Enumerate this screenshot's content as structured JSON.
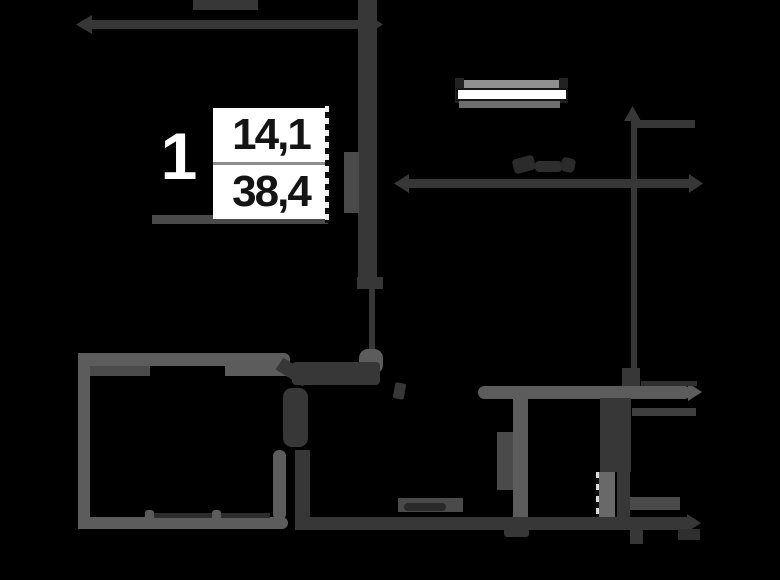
{
  "label": {
    "rooms": "1",
    "living_area": "14,1",
    "total_area": "38,4"
  },
  "palette": {
    "bg": "#000000",
    "dark": "#373737",
    "wall": "#5c5c5c",
    "medium": "#4a4a4a",
    "light": "#909090",
    "white": "#ffffff"
  },
  "plan": {
    "shapes": [
      {
        "name": "roof-stub",
        "type": "rect",
        "x": 193,
        "y": 0,
        "w": 65,
        "h": 10,
        "color": "dark"
      },
      {
        "name": "top-dim-line",
        "type": "rect",
        "x": 90,
        "y": 20,
        "w": 282,
        "h": 9,
        "color": "dark"
      },
      {
        "name": "top-dim-arrow-left",
        "type": "tri-left",
        "x": 76,
        "y": 15,
        "w": 16,
        "h": 19,
        "color": "dark"
      },
      {
        "name": "top-dim-arrow-right",
        "type": "tri-right",
        "x": 368,
        "y": 15,
        "w": 15,
        "h": 19,
        "color": "dark"
      },
      {
        "name": "upper-wall-vertical",
        "type": "rect",
        "x": 358,
        "y": 0,
        "w": 19,
        "h": 281,
        "color": "dark"
      },
      {
        "name": "upper-wall-side-block",
        "type": "rect",
        "x": 344,
        "y": 152,
        "w": 15,
        "h": 61,
        "color": "medium"
      },
      {
        "name": "upper-wall-break-block",
        "type": "rect",
        "x": 357,
        "y": 277,
        "w": 26,
        "h": 12,
        "color": "dark"
      },
      {
        "name": "upper-wall-thin",
        "type": "rect",
        "x": 369,
        "y": 283,
        "w": 6,
        "h": 68,
        "color": "dark"
      },
      {
        "name": "wall-junction-cap",
        "type": "rect",
        "x": 359,
        "y": 349,
        "w": 24,
        "h": 25,
        "r": 9,
        "color": "wall"
      },
      {
        "name": "label-underline-wall",
        "type": "rect",
        "x": 152,
        "y": 215,
        "w": 176,
        "h": 9,
        "color": "medium"
      },
      {
        "name": "label-dashed-line",
        "type": "dashes-v",
        "x": 325,
        "y": 106,
        "w": 4,
        "h": 117,
        "c1": "#f0f0f0",
        "c2": "#0d0d0d"
      },
      {
        "name": "window-top-bar",
        "type": "rect",
        "x": 458,
        "y": 80,
        "w": 104,
        "h": 8,
        "color": "light"
      },
      {
        "name": "window-cap-left",
        "type": "rect",
        "x": 455,
        "y": 78,
        "w": 9,
        "h": 25,
        "color": "#222222"
      },
      {
        "name": "window-cap-right",
        "type": "rect",
        "x": 559,
        "y": 78,
        "w": 9,
        "h": 25,
        "color": "#222222"
      },
      {
        "name": "window-frame",
        "type": "rect",
        "x": 456,
        "y": 88,
        "w": 112,
        "h": 13,
        "color": "white",
        "border": "2px solid #161616"
      },
      {
        "name": "window-sill-bar",
        "type": "rect",
        "x": 459,
        "y": 101,
        "w": 101,
        "h": 7,
        "color": "#6e6e6e"
      },
      {
        "name": "watermark-blob-1",
        "type": "rect",
        "x": 513,
        "y": 157,
        "w": 22,
        "h": 15,
        "r": 4,
        "rot": -15,
        "color": "#2b2b2b"
      },
      {
        "name": "watermark-blob-2",
        "type": "rect",
        "x": 535,
        "y": 161,
        "w": 27,
        "h": 11,
        "r": 4,
        "color": "#2e2e2e"
      },
      {
        "name": "watermark-blob-3",
        "type": "rect",
        "x": 561,
        "y": 158,
        "w": 14,
        "h": 14,
        "r": 4,
        "rot": 12,
        "color": "#2b2b2b"
      },
      {
        "name": "vert-dim-arrow-up",
        "type": "tri-up",
        "x": 624,
        "y": 106,
        "w": 17,
        "h": 15,
        "color": "dark"
      },
      {
        "name": "vert-dim-line",
        "type": "rect",
        "x": 631,
        "y": 120,
        "w": 6,
        "h": 267,
        "color": "dark"
      },
      {
        "name": "dim-branch-line",
        "type": "rect",
        "x": 637,
        "y": 120,
        "w": 58,
        "h": 8,
        "color": "dark"
      },
      {
        "name": "mid-dim-line",
        "type": "rect",
        "x": 408,
        "y": 179,
        "w": 284,
        "h": 9,
        "color": "dark"
      },
      {
        "name": "mid-dim-arrow-left",
        "type": "tri-left",
        "x": 394,
        "y": 174,
        "w": 15,
        "h": 19,
        "color": "dark"
      },
      {
        "name": "mid-dim-arrow-right",
        "type": "tri-right",
        "x": 689,
        "y": 174,
        "w": 14,
        "h": 19,
        "color": "dark"
      },
      {
        "name": "pre-wall-block",
        "type": "rect",
        "x": 622,
        "y": 368,
        "w": 18,
        "h": 18,
        "color": "dark"
      },
      {
        "name": "hall-wall",
        "type": "rect",
        "x": 478,
        "y": 386,
        "w": 213,
        "h": 13,
        "r": 7,
        "color": "wall"
      },
      {
        "name": "hall-wall-arrow",
        "type": "tri-right",
        "x": 688,
        "y": 383,
        "w": 14,
        "h": 18,
        "color": "wall"
      },
      {
        "name": "hall-wall-top-line",
        "type": "rect",
        "x": 641,
        "y": 381,
        "w": 56,
        "h": 5,
        "color": "#2f2f2f"
      },
      {
        "name": "bar-below-hall-wall",
        "type": "rect",
        "x": 632,
        "y": 408,
        "w": 64,
        "h": 8,
        "color": "#3f3f3f"
      },
      {
        "name": "bath-wall-vertical",
        "type": "rect",
        "x": 513,
        "y": 398,
        "w": 15,
        "h": 122,
        "color": "wall"
      },
      {
        "name": "bath-door-block",
        "type": "rect",
        "x": 497,
        "y": 432,
        "w": 16,
        "h": 58,
        "color": "medium"
      },
      {
        "name": "duct-block",
        "type": "rect",
        "x": 600,
        "y": 398,
        "w": 31,
        "h": 74,
        "color": "dark"
      },
      {
        "name": "duct-right-bar",
        "type": "rect",
        "x": 617,
        "y": 466,
        "w": 13,
        "h": 62,
        "color": "dark"
      },
      {
        "name": "duct-lower-bar",
        "type": "rect",
        "x": 599,
        "y": 472,
        "w": 16,
        "h": 56,
        "color": "#696969"
      },
      {
        "name": "duct-dashed-edge",
        "type": "dashes-v",
        "x": 596,
        "y": 472,
        "w": 3,
        "h": 56,
        "c1": "#dddddd",
        "c2": "#111111"
      },
      {
        "name": "door-tick",
        "type": "rect",
        "x": 394,
        "y": 383,
        "w": 11,
        "h": 16,
        "r": 2,
        "rot": 10,
        "color": "dark"
      },
      {
        "name": "room-top-wall",
        "type": "rect",
        "x": 78,
        "y": 353,
        "w": 212,
        "h": 13,
        "r": 6,
        "color": "wall"
      },
      {
        "name": "room-top-wall-under-left",
        "type": "rect",
        "x": 85,
        "y": 366,
        "w": 65,
        "h": 10,
        "color": "#4b4b4b"
      },
      {
        "name": "room-top-wall-under-right",
        "type": "rect",
        "x": 225,
        "y": 362,
        "w": 63,
        "h": 14,
        "color": "wall"
      },
      {
        "name": "room-left-wall",
        "type": "rect",
        "x": 78,
        "y": 353,
        "w": 12,
        "h": 176,
        "color": "wall"
      },
      {
        "name": "room-bottom-wall",
        "type": "rect",
        "x": 78,
        "y": 517,
        "w": 210,
        "h": 12,
        "r": 6,
        "color": "wall"
      },
      {
        "name": "glazing-line-1",
        "type": "rect",
        "x": 153,
        "y": 513,
        "w": 59,
        "h": 5,
        "color": "#2d2d2d"
      },
      {
        "name": "glazing-line-2",
        "type": "rect",
        "x": 220,
        "y": 513,
        "w": 50,
        "h": 5,
        "color": "#2d2d2d"
      },
      {
        "name": "wall-nub-1",
        "type": "rect",
        "x": 145,
        "y": 510,
        "w": 9,
        "h": 10,
        "r": 3,
        "color": "wall"
      },
      {
        "name": "wall-nub-2",
        "type": "rect",
        "x": 212,
        "y": 510,
        "w": 9,
        "h": 10,
        "r": 3,
        "color": "wall"
      },
      {
        "name": "room-right-wall-seg",
        "type": "rect",
        "x": 273,
        "y": 450,
        "w": 13,
        "h": 70,
        "r": 6,
        "color": "wall"
      },
      {
        "name": "door-band-vert",
        "type": "rect",
        "x": 283,
        "y": 388,
        "w": 25,
        "h": 59,
        "r": 9,
        "color": "dark"
      },
      {
        "name": "dark-bar-right-of-room",
        "type": "rect",
        "x": 295,
        "y": 450,
        "w": 15,
        "h": 80,
        "color": "dark"
      },
      {
        "name": "door-band-horiz",
        "type": "rect",
        "x": 292,
        "y": 362,
        "w": 88,
        "h": 23,
        "r": 4,
        "color": "dark"
      },
      {
        "name": "door-band-diag",
        "type": "rect",
        "x": 277,
        "y": 365,
        "w": 32,
        "h": 14,
        "rot": 32,
        "color": "dark"
      },
      {
        "name": "bottom-wall-dark",
        "type": "rect",
        "x": 298,
        "y": 517,
        "w": 392,
        "h": 13,
        "color": "dark"
      },
      {
        "name": "bottom-wall-arrow",
        "type": "tri-right",
        "x": 687,
        "y": 514,
        "w": 14,
        "h": 18,
        "color": "dark"
      },
      {
        "name": "utility-block-base",
        "type": "rect",
        "x": 398,
        "y": 498,
        "w": 65,
        "h": 14,
        "color": "medium"
      },
      {
        "name": "utility-block-marks",
        "type": "rect",
        "x": 404,
        "y": 503,
        "w": 42,
        "h": 8,
        "r": 4,
        "color": "#2a2a2a"
      },
      {
        "name": "bottom-right-bar",
        "type": "rect",
        "x": 630,
        "y": 497,
        "w": 50,
        "h": 13,
        "color": "medium"
      },
      {
        "name": "stub-below-duct",
        "type": "rect",
        "x": 630,
        "y": 529,
        "w": 13,
        "h": 15,
        "color": "dark"
      },
      {
        "name": "stub-below-right",
        "type": "rect",
        "x": 678,
        "y": 529,
        "w": 22,
        "h": 11,
        "color": "#2f2f2f"
      },
      {
        "name": "stub-below-bath",
        "type": "rect",
        "x": 504,
        "y": 528,
        "w": 25,
        "h": 9,
        "r": 3,
        "color": "dark"
      }
    ]
  }
}
